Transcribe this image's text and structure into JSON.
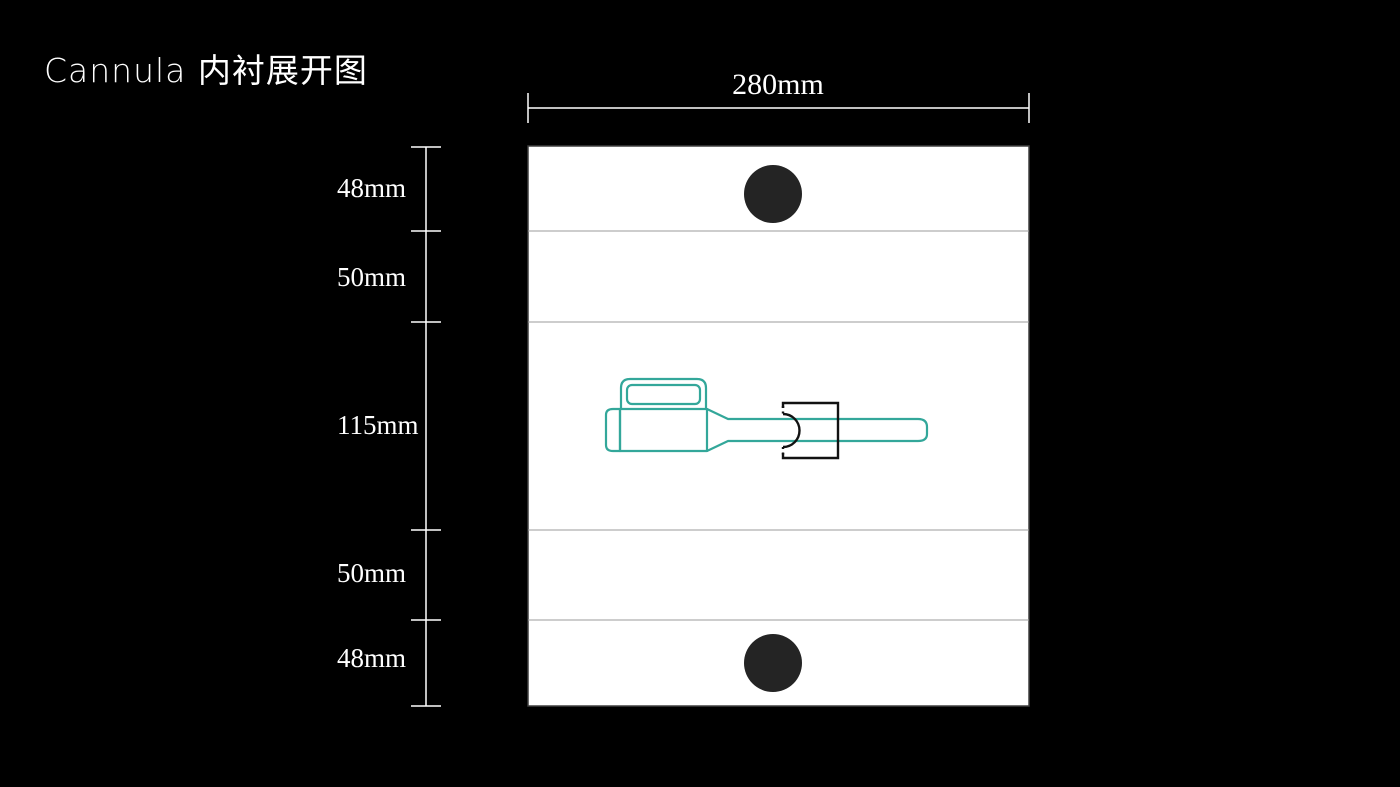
{
  "title": "Cannula 内衬展开图",
  "diagram": {
    "width_label": "280mm",
    "total_width_mm": 280,
    "sections": [
      {
        "label": "48mm",
        "height_mm": 48
      },
      {
        "label": "50mm",
        "height_mm": 50
      },
      {
        "label": "115mm",
        "height_mm": 115
      },
      {
        "label": "50mm",
        "height_mm": 50
      },
      {
        "label": "48mm",
        "height_mm": 48
      }
    ],
    "colors": {
      "background": "#000000",
      "panel_fill": "#ffffff",
      "panel_border": "#3f3f3f",
      "fold_line": "#9b9b9b",
      "hole_fill": "#242424",
      "device_outline": "#33a79a",
      "clamp_outline": "#121212",
      "dimension_color": "#ffffff",
      "title_color": "#ffffff"
    }
  }
}
